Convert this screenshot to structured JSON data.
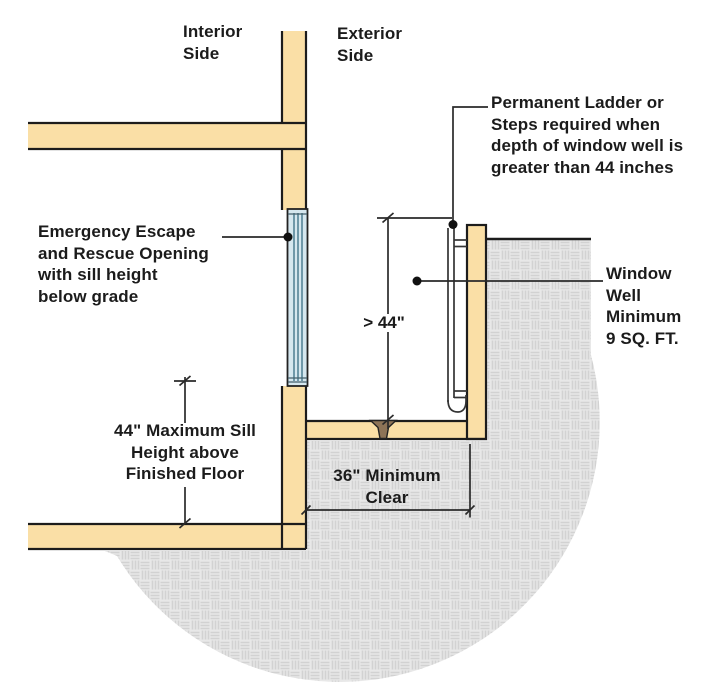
{
  "diagram_title": "Emergency escape and rescue opening with window well - section view",
  "labels": {
    "interior_side": {
      "lines": [
        "Interior",
        "Side"
      ]
    },
    "exterior_side": {
      "lines": [
        "Exterior",
        "Side"
      ]
    },
    "permanent_ladder": {
      "lines": [
        "Permanent Ladder or",
        "Steps required when",
        "depth of window well is",
        "greater than 44 inches"
      ]
    },
    "emergency_opening": {
      "lines": [
        "Emergency Escape",
        "and Rescue Opening",
        "with sill  height",
        "below grade"
      ]
    },
    "window_well_min": {
      "lines": [
        "Window",
        "Well",
        "Minimum",
        "9 SQ. FT."
      ]
    },
    "sill_height": {
      "lines": [
        "44\" Maximum Sill",
        "Height above",
        "Finished Floor"
      ]
    },
    "clear_width": {
      "lines": [
        "36\" Minimum",
        "Clear"
      ]
    },
    "well_depth": "> 44\""
  },
  "colors": {
    "wall_fill": "#FADFA6",
    "outline": "#1c1c1c",
    "window_glass": "#D5E7EF",
    "window_mullion": "#5D8A9D",
    "soil_background": "#E8E8E8",
    "soil_weave": "#D2D2D2",
    "drain_fill": "#8E7457",
    "annotation_line": "#2a2a2a",
    "text": "#1b1b1b"
  }
}
